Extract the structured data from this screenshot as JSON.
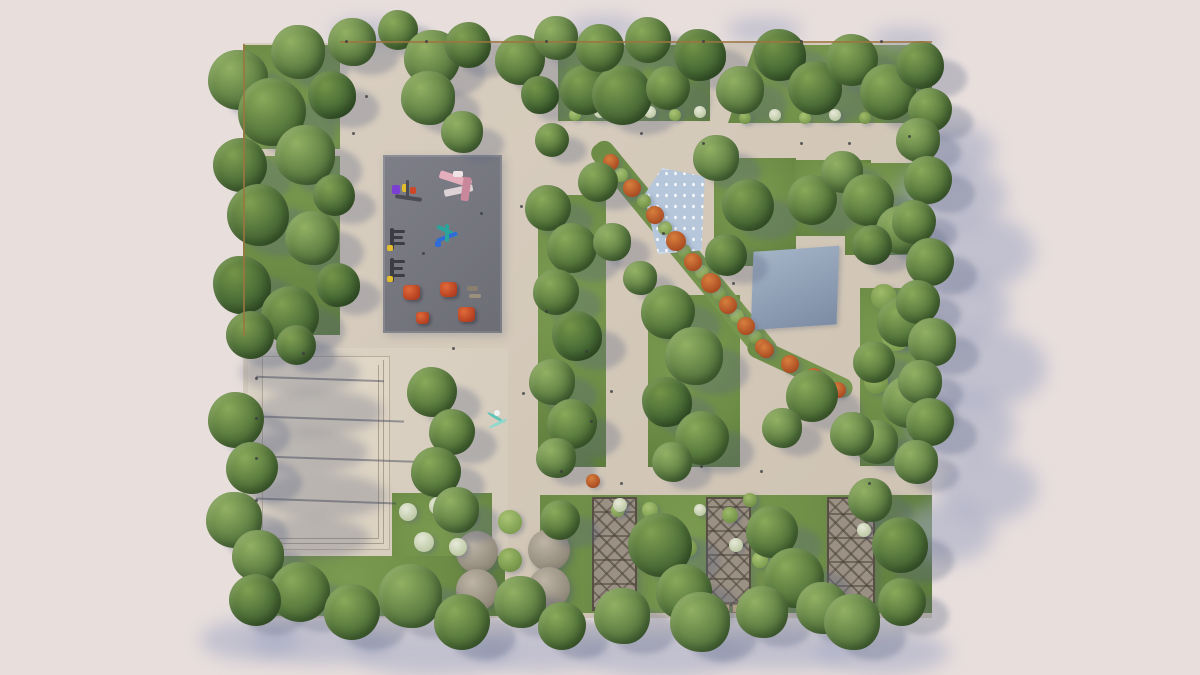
{
  "scene": {
    "description": "Top-down aerial 3D architectural render of a landscaped public park master plan with lawns, tree groves, paved walkways, a playground with colorful equipment, a dry fountain plaza, a reflecting pool, pergolas and round canopies",
    "canvas": {
      "w": 1200,
      "h": 675,
      "background": "#e8dfdd"
    },
    "palette": {
      "paving": "#d5cabb",
      "plaza_paving": "#ddd4c6",
      "grass": "#6d8c46",
      "tree_dark": "#3b5a2e",
      "playground_surface": "#75767e",
      "fountain_water": "#b6c7db",
      "pool": "#8d9db2",
      "autumn_shrub": "#b0512b",
      "pergola_wood": "#9a9083",
      "shadow": "#5c6680"
    },
    "park": {
      "x": 243,
      "y": 43,
      "w": 689,
      "h": 575
    },
    "plaza": {
      "x": 248,
      "y": 348,
      "w": 260,
      "h": 210
    },
    "platform": {
      "x": 262,
      "y": 356,
      "w": 126,
      "h": 192
    },
    "lawns": [
      {
        "name": "lawn-left",
        "x": 243,
        "y": 45,
        "w": 97,
        "h": 290
      },
      {
        "name": "lawn-top-center",
        "x": 558,
        "y": 45,
        "w": 152,
        "h": 76
      },
      {
        "name": "lawn-top-right",
        "x": 728,
        "y": 45,
        "w": 204,
        "h": 78,
        "clip": "polygon(13% 0,100% 0,100% 100%,0 100%)"
      },
      {
        "name": "lawn-strip-a",
        "x": 538,
        "y": 195,
        "w": 68,
        "h": 272
      },
      {
        "name": "lawn-strip-b",
        "x": 648,
        "y": 295,
        "w": 92,
        "h": 172
      },
      {
        "name": "lawn-water-east",
        "x": 714,
        "y": 158,
        "w": 82,
        "h": 108
      },
      {
        "name": "lawn-upper-right",
        "x": 795,
        "y": 160,
        "w": 76,
        "h": 76
      },
      {
        "name": "lawn-corner-ne",
        "x": 845,
        "y": 163,
        "w": 84,
        "h": 92
      },
      {
        "name": "lawn-pool-east",
        "x": 860,
        "y": 288,
        "w": 72,
        "h": 178
      },
      {
        "name": "lawn-bottom-main",
        "x": 540,
        "y": 495,
        "w": 392,
        "h": 118
      },
      {
        "name": "lawn-bottom-left",
        "x": 392,
        "y": 493,
        "w": 100,
        "h": 122
      },
      {
        "name": "lawn-bottom-row",
        "x": 243,
        "y": 556,
        "w": 262,
        "h": 60
      }
    ],
    "thin_paths": [
      [
        243,
        149,
        97,
        7
      ]
    ],
    "medians": [
      {
        "x": 546,
        "y": 239,
        "w": 276,
        "h": 24,
        "rot": 50.6
      },
      {
        "x": 743,
        "y": 358,
        "w": 114,
        "h": 20,
        "rot": 25
      }
    ],
    "water_feature": {
      "x": 644,
      "y": 168,
      "w": 64,
      "h": 86,
      "clip": "polygon(28% 0,95% 10%,90% 96%,22% 100%,0 32%)"
    },
    "pool": {
      "x": 752,
      "y": 249,
      "w": 86,
      "h": 78
    },
    "playground": {
      "x": 383,
      "y": 155,
      "w": 119,
      "h": 178,
      "equipment": [
        [
          9,
          30,
          8,
          9,
          "#7c3fd4",
          0
        ],
        [
          19,
          29,
          7,
          8,
          "#e3bd2b",
          0
        ],
        [
          27,
          32,
          6,
          7,
          "#cf4628",
          0
        ],
        [
          12,
          41,
          27,
          4,
          "#4c4c55",
          8
        ],
        [
          23,
          25,
          3,
          20,
          "#4c4c55",
          0
        ],
        [
          56,
          20,
          33,
          8,
          "#e5aebc",
          18
        ],
        [
          61,
          32,
          29,
          7,
          "#ddd3d6",
          -12
        ],
        [
          79,
          22,
          8,
          24,
          "#c9879c",
          8
        ],
        [
          70,
          16,
          10,
          6,
          "#efe3e6",
          0
        ],
        [
          7,
          73,
          4,
          22,
          "#3c3c45",
          0
        ],
        [
          9,
          75,
          13,
          3,
          "#3c3c45",
          0
        ],
        [
          9,
          81,
          11,
          3,
          "#3c3c45",
          0
        ],
        [
          9,
          87,
          13,
          3,
          "#3c3c45",
          0
        ],
        [
          4,
          90,
          6,
          6,
          "#e3bd2b",
          0
        ],
        [
          7,
          103,
          4,
          24,
          "#3c3c45",
          0
        ],
        [
          9,
          105,
          13,
          3,
          "#3c3c45",
          0
        ],
        [
          9,
          112,
          11,
          3,
          "#3c3c45",
          0
        ],
        [
          9,
          119,
          13,
          3,
          "#3c3c45",
          0
        ],
        [
          4,
          121,
          6,
          6,
          "#e3bd2b",
          0
        ],
        [
          53,
          74,
          22,
          4,
          "#2ba39b",
          25
        ],
        [
          53,
          80,
          22,
          4,
          "#2f6cd8",
          -20
        ],
        [
          62,
          69,
          4,
          18,
          "#2ba39b",
          0
        ],
        [
          52,
          86,
          6,
          6,
          "#2f6cd8",
          0
        ],
        [
          84,
          131,
          11,
          5,
          "#8a7f6e",
          0
        ],
        [
          86,
          139,
          12,
          4,
          "#9a8f7c",
          0
        ]
      ],
      "climb_triangles": [
        [
          20,
          130,
          17
        ],
        [
          57,
          127,
          17
        ],
        [
          75,
          152,
          17
        ],
        [
          33,
          157,
          13
        ]
      ]
    },
    "pergolas": [
      {
        "x": 592,
        "y": 497,
        "w": 41,
        "h": 110
      },
      {
        "x": 706,
        "y": 497,
        "w": 41,
        "h": 105
      },
      {
        "x": 827,
        "y": 497,
        "w": 44,
        "h": 112
      }
    ],
    "pergola_benches": [
      [
        598,
        608,
        16,
        7
      ],
      [
        618,
        608,
        14,
        7
      ],
      [
        712,
        604,
        16,
        7
      ],
      [
        732,
        604,
        13,
        7
      ],
      [
        833,
        612,
        16,
        7
      ],
      [
        853,
        612,
        14,
        7
      ]
    ],
    "canopies": [
      [
        477,
        552,
        21
      ],
      [
        477,
        590,
        21
      ],
      [
        549,
        550,
        21
      ],
      [
        549,
        588,
        21
      ]
    ],
    "sculpture": {
      "x": 486,
      "y": 408
    },
    "trees": [
      [
        238,
        80,
        30
      ],
      [
        272,
        112,
        34
      ],
      [
        240,
        165,
        27
      ],
      [
        305,
        155,
        30
      ],
      [
        258,
        215,
        31
      ],
      [
        312,
        238,
        27
      ],
      [
        242,
        285,
        29
      ],
      [
        290,
        315,
        29
      ],
      [
        332,
        95,
        24
      ],
      [
        334,
        195,
        21
      ],
      [
        338,
        285,
        22
      ],
      [
        250,
        335,
        24
      ],
      [
        236,
        420,
        28
      ],
      [
        252,
        468,
        26
      ],
      [
        234,
        520,
        28
      ],
      [
        258,
        556,
        26
      ],
      [
        296,
        345,
        20
      ],
      [
        298,
        52,
        27
      ],
      [
        352,
        42,
        24
      ],
      [
        398,
        30,
        20
      ],
      [
        432,
        58,
        28
      ],
      [
        468,
        45,
        23
      ],
      [
        520,
        60,
        25
      ],
      [
        556,
        38,
        22
      ],
      [
        585,
        90,
        25
      ],
      [
        622,
        95,
        30
      ],
      [
        600,
        48,
        24
      ],
      [
        648,
        40,
        23
      ],
      [
        668,
        88,
        22
      ],
      [
        700,
        55,
        26
      ],
      [
        740,
        90,
        24
      ],
      [
        780,
        55,
        26
      ],
      [
        815,
        88,
        27
      ],
      [
        852,
        60,
        26
      ],
      [
        888,
        92,
        28
      ],
      [
        920,
        65,
        24
      ],
      [
        930,
        110,
        22
      ],
      [
        428,
        98,
        27
      ],
      [
        462,
        132,
        21
      ],
      [
        540,
        95,
        19
      ],
      [
        552,
        140,
        17
      ],
      [
        548,
        208,
        23
      ],
      [
        572,
        248,
        25
      ],
      [
        556,
        292,
        23
      ],
      [
        577,
        336,
        25
      ],
      [
        552,
        382,
        23
      ],
      [
        572,
        424,
        25
      ],
      [
        556,
        458,
        20
      ],
      [
        668,
        312,
        27
      ],
      [
        694,
        356,
        29
      ],
      [
        667,
        402,
        25
      ],
      [
        702,
        438,
        27
      ],
      [
        672,
        462,
        20
      ],
      [
        612,
        242,
        19
      ],
      [
        640,
        278,
        17
      ],
      [
        716,
        158,
        23
      ],
      [
        748,
        205,
        26
      ],
      [
        726,
        255,
        21
      ],
      [
        598,
        182,
        20
      ],
      [
        812,
        200,
        25
      ],
      [
        842,
        172,
        21
      ],
      [
        868,
        200,
        26
      ],
      [
        900,
        230,
        24
      ],
      [
        872,
        245,
        20
      ],
      [
        902,
        322,
        25
      ],
      [
        874,
        362,
        21
      ],
      [
        908,
        402,
        26
      ],
      [
        876,
        442,
        22
      ],
      [
        918,
        140,
        22
      ],
      [
        928,
        180,
        24
      ],
      [
        914,
        222,
        22
      ],
      [
        930,
        262,
        24
      ],
      [
        918,
        302,
        22
      ],
      [
        932,
        342,
        24
      ],
      [
        920,
        382,
        22
      ],
      [
        930,
        422,
        24
      ],
      [
        916,
        462,
        22
      ],
      [
        432,
        392,
        25
      ],
      [
        452,
        432,
        23
      ],
      [
        436,
        472,
        25
      ],
      [
        456,
        510,
        23
      ],
      [
        812,
        396,
        26
      ],
      [
        852,
        434,
        22
      ],
      [
        782,
        428,
        20
      ],
      [
        560,
        520,
        20
      ],
      [
        660,
        545,
        32
      ],
      [
        684,
        592,
        28
      ],
      [
        772,
        532,
        26
      ],
      [
        794,
        578,
        30
      ],
      [
        900,
        545,
        28
      ],
      [
        822,
        608,
        26
      ],
      [
        870,
        500,
        22
      ],
      [
        300,
        592,
        30
      ],
      [
        352,
        612,
        28
      ],
      [
        410,
        596,
        32
      ],
      [
        462,
        622,
        28
      ],
      [
        520,
        602,
        26
      ],
      [
        562,
        626,
        24
      ],
      [
        622,
        616,
        28
      ],
      [
        700,
        622,
        30
      ],
      [
        762,
        612,
        26
      ],
      [
        852,
        622,
        28
      ],
      [
        902,
        602,
        24
      ],
      [
        255,
        600,
        26
      ]
    ],
    "shrubs": [
      [
        621,
        175,
        7
      ],
      [
        644,
        201,
        7
      ],
      [
        665,
        228,
        7
      ],
      [
        684,
        251,
        7
      ],
      [
        702,
        272,
        7
      ],
      [
        719,
        294,
        7
      ],
      [
        737,
        316,
        7
      ],
      [
        755,
        337,
        7
      ],
      [
        575,
        115,
        6
      ],
      [
        625,
        115,
        6
      ],
      [
        675,
        115,
        6
      ],
      [
        745,
        118,
        6
      ],
      [
        805,
        118,
        6
      ],
      [
        865,
        118,
        6
      ],
      [
        510,
        522,
        12
      ],
      [
        510,
        560,
        12
      ],
      [
        510,
        597,
        12
      ],
      [
        884,
        297,
        13
      ],
      [
        896,
        337,
        14
      ],
      [
        876,
        382,
        12
      ],
      [
        650,
        510,
        8
      ],
      [
        730,
        515,
        8
      ],
      [
        760,
        560,
        8
      ],
      [
        688,
        548,
        9
      ],
      [
        618,
        510,
        7
      ],
      [
        750,
        500,
        7
      ]
    ],
    "white_shrubs": [
      [
        408,
        512,
        9
      ],
      [
        438,
        506,
        9
      ],
      [
        468,
        516,
        9
      ],
      [
        424,
        542,
        10
      ],
      [
        458,
        547,
        9
      ],
      [
        600,
        112,
        6
      ],
      [
        650,
        112,
        6
      ],
      [
        700,
        112,
        6
      ],
      [
        775,
        115,
        6
      ],
      [
        835,
        115,
        6
      ],
      [
        620,
        505,
        7
      ],
      [
        648,
        530,
        7
      ],
      [
        736,
        545,
        7
      ],
      [
        700,
        510,
        6
      ],
      [
        864,
        530,
        7
      ]
    ],
    "autumn_shrubs": [
      [
        611,
        162,
        8
      ],
      [
        632,
        188,
        9
      ],
      [
        655,
        215,
        9
      ],
      [
        676,
        241,
        10
      ],
      [
        693,
        262,
        9
      ],
      [
        711,
        283,
        10
      ],
      [
        728,
        305,
        9
      ],
      [
        746,
        326,
        9
      ],
      [
        763,
        347,
        8
      ],
      [
        766,
        350,
        8
      ],
      [
        790,
        364,
        9
      ],
      [
        814,
        377,
        9
      ],
      [
        838,
        390,
        8
      ],
      [
        593,
        481,
        7
      ]
    ],
    "plaza_shadows": [
      [
        300,
        372,
        120,
        44
      ],
      [
        318,
        412,
        130,
        46
      ],
      [
        306,
        452,
        124,
        44
      ],
      [
        322,
        496,
        130,
        46
      ],
      [
        310,
        538,
        120,
        42
      ]
    ],
    "pole_shadows": [
      [
        256,
        378,
        128,
        2
      ],
      [
        256,
        418,
        148,
        2
      ],
      [
        256,
        458,
        158,
        2
      ],
      [
        256,
        500,
        140,
        2
      ]
    ],
    "pole_dots": [
      [
        255,
        377
      ],
      [
        255,
        417
      ],
      [
        255,
        457
      ],
      [
        255,
        499
      ],
      [
        345,
        40
      ],
      [
        425,
        40
      ],
      [
        545,
        40
      ],
      [
        702,
        40
      ],
      [
        800,
        40
      ],
      [
        880,
        40
      ]
    ],
    "overhang_shadows": [
      [
        952,
        195,
        55,
        32
      ],
      [
        975,
        252,
        60,
        38
      ],
      [
        958,
        308,
        52,
        34
      ],
      [
        985,
        368,
        62,
        40
      ],
      [
        962,
        428,
        54,
        36
      ],
      [
        988,
        488,
        50,
        34
      ],
      [
        948,
        532,
        46,
        30
      ],
      [
        955,
        150,
        40,
        26
      ],
      [
        320,
        642,
        70,
        22
      ],
      [
        432,
        652,
        80,
        24
      ],
      [
        540,
        650,
        68,
        22
      ],
      [
        662,
        654,
        80,
        24
      ],
      [
        780,
        648,
        74,
        22
      ],
      [
        882,
        652,
        68,
        22
      ],
      [
        250,
        640,
        50,
        20
      ],
      [
        368,
        32,
        38,
        12
      ],
      [
        604,
        28,
        38,
        12
      ],
      [
        764,
        30,
        38,
        12
      ],
      [
        906,
        40,
        36,
        12
      ]
    ],
    "fences": [
      [
        340,
        41,
        592,
        2
      ],
      [
        243,
        44,
        2,
        292
      ]
    ],
    "people_dots": [
      [
        520,
        205
      ],
      [
        640,
        132
      ],
      [
        702,
        142
      ],
      [
        560,
        470
      ],
      [
        620,
        482
      ],
      [
        760,
        470
      ],
      [
        848,
        142
      ],
      [
        452,
        347
      ],
      [
        302,
        352
      ],
      [
        522,
        392
      ],
      [
        610,
        390
      ],
      [
        662,
        232
      ],
      [
        732,
        282
      ],
      [
        800,
        142
      ],
      [
        868,
        482
      ],
      [
        352,
        132
      ],
      [
        422,
        252
      ],
      [
        480,
        212
      ],
      [
        545,
        310
      ],
      [
        590,
        420
      ],
      [
        700,
        465
      ],
      [
        365,
        95
      ],
      [
        908,
        135
      ],
      [
        585,
        350
      ]
    ]
  }
}
